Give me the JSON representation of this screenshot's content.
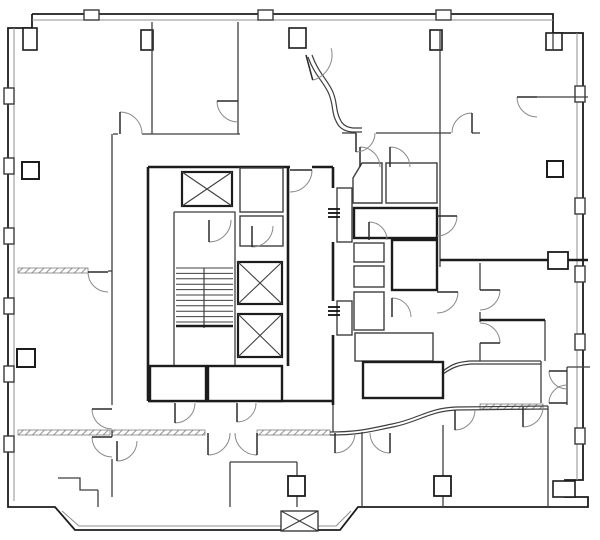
{
  "title": "architectural-floor-plan",
  "canvas": {
    "w": 600,
    "h": 540
  },
  "colors": {
    "bg": "#ffffff",
    "wall_dark": "#1c1c1c",
    "wall_mid": "#3f3f3f",
    "wall_light": "#8f8f8f",
    "hatch": "#9a9a9a",
    "door_arc": "#8a8a8a",
    "door_leaf": "#2a2a2a",
    "mullion": "#3a3a3a"
  },
  "plan": {
    "outline": "32,14 553,14 553,33 583,33 583,480 565,480 565,497 588,497 588,507 358,507 340,530 75,530 55,507 8,507 8,28 32,28 32,14",
    "inner_band": [
      "32,20 553,20",
      "14,28 14,501",
      "577,33 577,480",
      "62,511 79,526 336,526 351,511"
    ],
    "mullions_top": [
      [
        84,
        10,
        15,
        10
      ],
      [
        258,
        10,
        15,
        10
      ],
      [
        436,
        10,
        15,
        10
      ]
    ],
    "mullions_left": [
      [
        4,
        88,
        10,
        16
      ],
      [
        4,
        158,
        10,
        16
      ],
      [
        4,
        228,
        10,
        16
      ],
      [
        4,
        298,
        10,
        16
      ],
      [
        4,
        366,
        10,
        16
      ],
      [
        4,
        436,
        10,
        16
      ]
    ],
    "mullions_right": [
      [
        575,
        86,
        10,
        16
      ],
      [
        575,
        198,
        10,
        16
      ],
      [
        575,
        266,
        10,
        16
      ],
      [
        575,
        334,
        10,
        16
      ],
      [
        575,
        428,
        10,
        16
      ]
    ],
    "pilasters": [
      [
        141,
        30,
        12,
        20
      ],
      [
        289,
        28,
        17,
        20
      ],
      [
        430,
        30,
        12,
        20
      ],
      [
        546,
        33,
        16,
        17
      ],
      [
        23,
        28,
        14,
        22
      ],
      [
        553,
        481,
        22,
        16
      ]
    ],
    "walls_thin": [
      "152,22 152,134",
      "238,22 238,134",
      "113,134 118,134",
      "142,134 240,134",
      "440,30 440,267",
      "342,133 356,133",
      "376,133 451,133",
      "472,133 480,133",
      "537,97 588,97",
      "553,33 553,50",
      "112,134 112,405",
      "112,430 112,437",
      "112,459 112,497",
      "108,271 112,271",
      "230,462 297,462",
      "230,462 230,507",
      "297,462 297,507",
      "362,432 362,507",
      "443,425 443,507",
      "548,406 548,507",
      "567,367 567,405",
      "567,367 590,367",
      "545,320 545,361",
      "541,361 541,403",
      "480,263 480,290",
      "480,312 480,322",
      "480,343 480,361",
      "98,490 98,507",
      "58,478 80,478 80,490 98,490",
      "174,212 235,212 235,366 174,366 174,212",
      "333,405 333,432"
    ],
    "walls_thick": [
      "148,167 290,167",
      "312,167 333,167",
      "148,167 148,401",
      "333,167 333,188",
      "333,242 333,301",
      "333,335 333,405",
      "148,401 175,401",
      "196,401 237,401",
      "257,401 333,401",
      "288,167 288,366",
      "440,260 548,260",
      "568,260 588,260",
      "480,320 545,320"
    ],
    "hatch_walls": [
      [
        18,
        268,
        70,
        5
      ],
      [
        18,
        430,
        92,
        5
      ],
      [
        112,
        430,
        93,
        5
      ],
      [
        257,
        430,
        73,
        5
      ],
      [
        480,
        404,
        63,
        5
      ]
    ],
    "rooms_thin": [
      [
        240,
        168,
        43,
        44
      ],
      [
        240,
        216,
        43,
        30
      ],
      [
        337,
        188,
        15,
        54
      ],
      [
        337,
        301,
        15,
        34
      ],
      [
        354,
        243,
        30,
        19
      ],
      [
        354,
        266,
        30,
        21
      ],
      [
        354,
        292,
        30,
        38
      ],
      [
        355,
        333,
        78,
        28
      ],
      [
        386,
        163,
        51,
        40
      ]
    ],
    "rooms_thick": [
      [
        150,
        366,
        56,
        35
      ],
      [
        208,
        366,
        74,
        35
      ],
      [
        354,
        208,
        83,
        30
      ],
      [
        392,
        240,
        45,
        50
      ],
      [
        363,
        362,
        80,
        36
      ]
    ],
    "room_polys": [
      "353,178 362,163 382,163 382,203 353,203 353,178"
    ],
    "elevators": [
      {
        "x": 182,
        "y": 172,
        "w": 50,
        "h": 34,
        "bold": true
      },
      {
        "x": 238,
        "y": 262,
        "w": 44,
        "h": 42,
        "bold": true
      },
      {
        "x": 238,
        "y": 314,
        "w": 44,
        "h": 43,
        "bold": true
      },
      {
        "x": 281,
        "y": 511,
        "w": 37,
        "h": 20,
        "bold": false
      }
    ],
    "stair": {
      "x": 176,
      "y": 268,
      "w": 57,
      "n": 11,
      "step": 5.4,
      "div_x": 204,
      "heavy_y": 326
    },
    "curves": [
      "M 308,57 C 314,74 322,80 328,92 C 334,104 331,112 336,121 Q 340,131 352,132 L 362,132",
      "M 312,55 C 318,72 326,78 332,90 C 338,102 335,110 340,119 Q 343,127 353,128 L 362,128",
      "M 443,371 C 452,364 458,362 470,361 L 541,361",
      "M 443,374 C 453,367 459,365 471,364 L 541,364",
      "M 330,432 C 360,432 372,428 392,424 C 418,419 428,408 456,407 L 548,406",
      "M 330,435 C 361,435 373,431 393,427 C 419,422 429,411 457,410 L 548,409"
    ],
    "columns": [
      [
        22,
        162,
        17
      ],
      [
        17,
        349,
        18
      ],
      [
        547,
        161,
        16
      ]
    ],
    "connectors": [
      [
        548,
        252,
        20,
        17
      ]
    ],
    "chases": [
      [
        288,
        476,
        17,
        20
      ],
      [
        434,
        476,
        17,
        20
      ]
    ],
    "hinge_ticks": [
      [
        333,
        209
      ],
      [
        333,
        307
      ]
    ],
    "doors": [
      [
        120,
        134,
        22,
        -90,
        1
      ],
      [
        238,
        101,
        21,
        180,
        -1
      ],
      [
        306,
        55,
        26,
        75,
        -1
      ],
      [
        472,
        133,
        20,
        -90,
        -1
      ],
      [
        537,
        97,
        20,
        180,
        -1
      ],
      [
        290,
        170,
        22,
        0,
        1
      ],
      [
        209,
        220,
        22,
        90,
        -1
      ],
      [
        252,
        226,
        21,
        90,
        -1
      ],
      [
        360,
        167,
        20,
        -90,
        1
      ],
      [
        390,
        167,
        20,
        -90,
        1
      ],
      [
        437,
        216,
        20,
        0,
        1
      ],
      [
        437,
        292,
        21,
        0,
        1
      ],
      [
        369,
        240,
        18,
        -90,
        1
      ],
      [
        175,
        403,
        20,
        90,
        -1
      ],
      [
        237,
        403,
        19,
        90,
        -1
      ],
      [
        112,
        409,
        20,
        180,
        -1
      ],
      [
        112,
        437,
        20,
        180,
        -1
      ],
      [
        117,
        441,
        20,
        90,
        -1
      ],
      [
        208,
        433,
        22,
        90,
        -1
      ],
      [
        257,
        433,
        22,
        90,
        1
      ],
      [
        335,
        433,
        20,
        90,
        -1
      ],
      [
        390,
        433,
        20,
        90,
        1
      ],
      [
        455,
        410,
        20,
        90,
        -1
      ],
      [
        523,
        407,
        20,
        90,
        -1
      ],
      [
        567,
        371,
        18,
        180,
        -1
      ],
      [
        567,
        403,
        18,
        180,
        1
      ],
      [
        480,
        290,
        20,
        0,
        1
      ],
      [
        480,
        343,
        20,
        0,
        -1
      ],
      [
        108,
        272,
        20,
        180,
        -1
      ],
      [
        356,
        133,
        19,
        90,
        -1
      ],
      [
        392,
        317,
        19,
        -90,
        1
      ]
    ]
  }
}
